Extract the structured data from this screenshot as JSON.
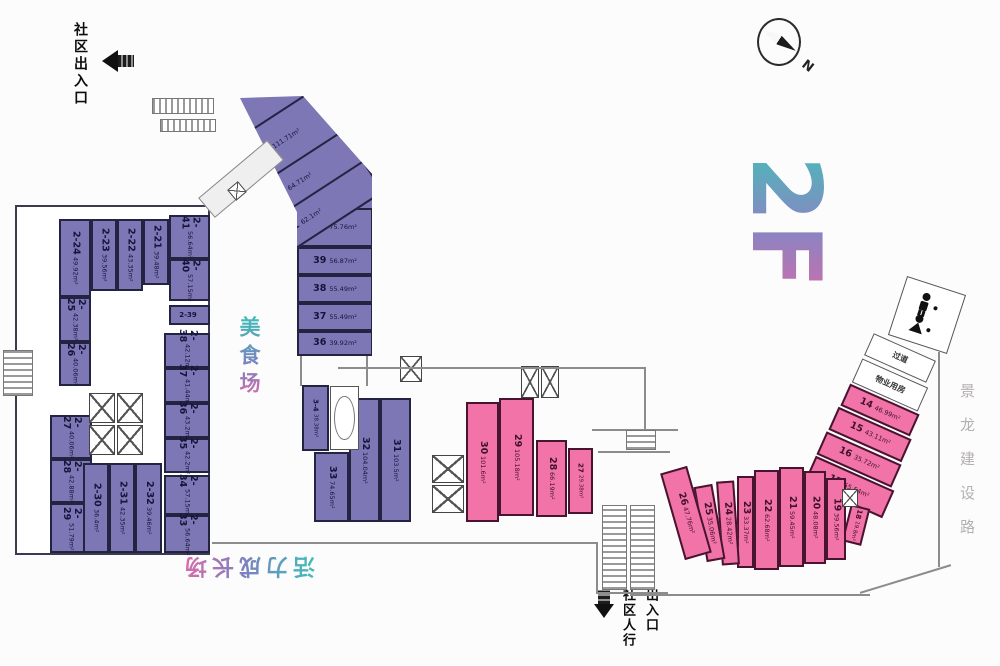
{
  "title": {
    "floor_label": "2F"
  },
  "annotations": {
    "entrance_top": "社区出入口",
    "entrance_bottom_line1": "社区人行",
    "entrance_bottom_line2": "出入口",
    "food_court": "美食场",
    "vitality": "活力成长场",
    "road": "景龙建设路",
    "compass_n": "N",
    "corridor": "过道",
    "property_room": "物业用房"
  },
  "colors": {
    "purple": "#7d77b6",
    "pink": "#f173a8",
    "accent_teal": "#3fbdb8",
    "accent_pink": "#e06aa8"
  },
  "rooms": [
    {
      "n": "40",
      "a": "75.76m²",
      "x": 97,
      "y": 118,
      "w": 76,
      "h": 39,
      "c": "purple",
      "ld": "h",
      "z": "top"
    },
    {
      "n": "39",
      "a": "56.87m²",
      "x": 97,
      "y": 157,
      "w": 76,
      "h": 28,
      "c": "purple",
      "ld": "h",
      "z": "top"
    },
    {
      "n": "38",
      "a": "55.49m²",
      "x": 97,
      "y": 185,
      "w": 76,
      "h": 28,
      "c": "purple",
      "ld": "h",
      "z": "top"
    },
    {
      "n": "37",
      "a": "55.49m²",
      "x": 97,
      "y": 213,
      "w": 76,
      "h": 28,
      "c": "purple",
      "ld": "h",
      "z": "top"
    },
    {
      "n": "36",
      "a": "39.92m²",
      "x": 97,
      "y": 241,
      "w": 76,
      "h": 25,
      "c": "purple",
      "ld": "h",
      "z": "top"
    },
    {
      "n": "43",
      "a": "111.71m²",
      "x": -8,
      "y": 26,
      "w": 175,
      "h": 54,
      "r": -33,
      "c": "purple",
      "ld": "h",
      "z": "top"
    },
    {
      "n": "42",
      "a": "64.71m²",
      "x": 8,
      "y": 76,
      "w": 170,
      "h": 40,
      "r": -33,
      "c": "purple",
      "ld": "h",
      "z": "top"
    },
    {
      "n": "41",
      "a": "62.1m²",
      "x": 22,
      "y": 112,
      "w": 165,
      "h": 38,
      "r": -33,
      "c": "purple",
      "ld": "h",
      "z": "top"
    },
    {
      "n": "2-24",
      "a": "49.92m²",
      "x": 42,
      "y": 12,
      "w": 32,
      "h": 78,
      "c": "purple",
      "ld": "v",
      "z": "left"
    },
    {
      "n": "2-23",
      "a": "39.56m²",
      "x": 74,
      "y": 12,
      "w": 26,
      "h": 72,
      "c": "purple",
      "ld": "v",
      "z": "left"
    },
    {
      "n": "2-22",
      "a": "43.35m²",
      "x": 100,
      "y": 12,
      "w": 26,
      "h": 72,
      "c": "purple",
      "ld": "v",
      "z": "left"
    },
    {
      "n": "2-21",
      "a": "39.48m²",
      "x": 126,
      "y": 12,
      "w": 26,
      "h": 66,
      "c": "purple",
      "ld": "v",
      "z": "left"
    },
    {
      "n": "2-41",
      "a": "56.64m²",
      "x": 152,
      "y": 8,
      "w": 41,
      "h": 44,
      "c": "purple",
      "ld": "v",
      "z": "left"
    },
    {
      "n": "2-40",
      "a": "57.15m²",
      "x": 152,
      "y": 52,
      "w": 41,
      "h": 42,
      "c": "purple",
      "ld": "v",
      "z": "left"
    },
    {
      "n": "2-39",
      "a": "",
      "x": 152,
      "y": 98,
      "w": 41,
      "h": 20,
      "c": "purple",
      "ld": "h",
      "cls": "small",
      "z": "left"
    },
    {
      "n": "2-38",
      "a": "42.12m²",
      "x": 147,
      "y": 126,
      "w": 46,
      "h": 35,
      "c": "purple",
      "ld": "v",
      "z": "left"
    },
    {
      "n": "2-37",
      "a": "41.44m²",
      "x": 147,
      "y": 161,
      "w": 46,
      "h": 35,
      "c": "purple",
      "ld": "v",
      "z": "left"
    },
    {
      "n": "2-36",
      "a": "43.2m²",
      "x": 147,
      "y": 196,
      "w": 46,
      "h": 35,
      "c": "purple",
      "ld": "v",
      "z": "left"
    },
    {
      "n": "2-35",
      "a": "42.2m²",
      "x": 147,
      "y": 231,
      "w": 46,
      "h": 35,
      "c": "purple",
      "ld": "v",
      "z": "left"
    },
    {
      "n": "2-34",
      "a": "57.15m²",
      "x": 147,
      "y": 268,
      "w": 46,
      "h": 40,
      "c": "purple",
      "ld": "v",
      "z": "left"
    },
    {
      "n": "2-33",
      "a": "56.64m²",
      "x": 147,
      "y": 308,
      "w": 46,
      "h": 38,
      "c": "purple",
      "ld": "v",
      "z": "left"
    },
    {
      "n": "2-25",
      "a": "42.38m²",
      "x": 42,
      "y": 90,
      "w": 32,
      "h": 45,
      "c": "purple",
      "ld": "v",
      "z": "left"
    },
    {
      "n": "2-26",
      "a": "40.06m²",
      "x": 42,
      "y": 135,
      "w": 32,
      "h": 44,
      "c": "purple",
      "ld": "v",
      "z": "left"
    },
    {
      "n": "2-27",
      "a": "40.06m²",
      "x": 33,
      "y": 208,
      "w": 42,
      "h": 44,
      "c": "purple",
      "ld": "v",
      "z": "left"
    },
    {
      "n": "2-28",
      "a": "42.88m²",
      "x": 33,
      "y": 252,
      "w": 42,
      "h": 44,
      "c": "purple",
      "ld": "v",
      "z": "left"
    },
    {
      "n": "2-29",
      "a": "51.79m²",
      "x": 33,
      "y": 296,
      "w": 42,
      "h": 50,
      "c": "purple",
      "ld": "v",
      "z": "left"
    },
    {
      "n": "2-30",
      "a": "36.4m²",
      "x": 66,
      "y": 256,
      "w": 26,
      "h": 90,
      "c": "purple",
      "ld": "v",
      "z": "left"
    },
    {
      "n": "2-31",
      "a": "42.35m²",
      "x": 92,
      "y": 256,
      "w": 26,
      "h": 90,
      "c": "purple",
      "ld": "v",
      "z": "left"
    },
    {
      "n": "2-32",
      "a": "39.46m²",
      "x": 118,
      "y": 256,
      "w": 27,
      "h": 90,
      "c": "purple",
      "ld": "v",
      "z": "left"
    },
    {
      "n": "3-4",
      "a": "38.38m²",
      "x": 302,
      "y": 385,
      "w": 27,
      "h": 66,
      "c": "purple",
      "ld": "v",
      "cls": "small"
    },
    {
      "n": "33",
      "a": "74.65m²",
      "x": 314,
      "y": 452,
      "w": 35,
      "h": 70,
      "c": "purple",
      "ld": "v"
    },
    {
      "n": "32",
      "a": "104.04m²",
      "x": 349,
      "y": 398,
      "w": 31,
      "h": 124,
      "c": "purple",
      "ld": "v"
    },
    {
      "n": "31",
      "a": "103.5m²",
      "x": 380,
      "y": 398,
      "w": 31,
      "h": 124,
      "c": "purple",
      "ld": "v"
    },
    {
      "n": "30",
      "a": "101.6m²",
      "x": 466,
      "y": 402,
      "w": 33,
      "h": 120,
      "c": "pink",
      "ld": "v"
    },
    {
      "n": "29",
      "a": "105.18m²",
      "x": 499,
      "y": 398,
      "w": 35,
      "h": 118,
      "c": "pink",
      "ld": "v"
    },
    {
      "n": "28",
      "a": "66.19m²",
      "x": 536,
      "y": 440,
      "w": 31,
      "h": 77,
      "c": "pink",
      "ld": "v"
    },
    {
      "n": "27",
      "a": "29.38m²",
      "x": 568,
      "y": 448,
      "w": 25,
      "h": 66,
      "c": "pink",
      "ld": "v",
      "cls": "small"
    },
    {
      "n": "14",
      "a": "46.99m²",
      "x": 842,
      "y": 398,
      "w": 76,
      "h": 24,
      "r": 24,
      "c": "pink",
      "ld": "h"
    },
    {
      "n": "15",
      "a": "43.11m²",
      "x": 830,
      "y": 422,
      "w": 80,
      "h": 25,
      "r": 24,
      "c": "pink",
      "ld": "h"
    },
    {
      "n": "16",
      "a": "35.72m²",
      "x": 818,
      "y": 447,
      "w": 82,
      "h": 25,
      "r": 24,
      "c": "pink",
      "ld": "h"
    },
    {
      "n": "17",
      "a": "55.54m²",
      "x": 806,
      "y": 472,
      "w": 86,
      "h": 30,
      "r": 24,
      "c": "pink",
      "ld": "h"
    },
    {
      "n": "18",
      "a": "19.8m²",
      "x": 846,
      "y": 506,
      "w": 20,
      "h": 38,
      "r": 14,
      "c": "pink",
      "ld": "v",
      "cls": "small"
    },
    {
      "n": "19",
      "a": "39.56m²",
      "x": 826,
      "y": 478,
      "w": 20,
      "h": 82,
      "c": "pink",
      "ld": "v"
    },
    {
      "n": "20",
      "a": "48.08m²",
      "x": 804,
      "y": 471,
      "w": 22,
      "h": 93,
      "c": "pink",
      "ld": "v"
    },
    {
      "n": "21",
      "a": "59.45m²",
      "x": 779,
      "y": 467,
      "w": 25,
      "h": 100,
      "c": "pink",
      "ld": "v"
    },
    {
      "n": "22",
      "a": "62.68m²",
      "x": 754,
      "y": 470,
      "w": 25,
      "h": 100,
      "c": "pink",
      "ld": "v"
    },
    {
      "n": "23",
      "a": "33.37m²",
      "x": 737,
      "y": 476,
      "w": 17,
      "h": 92,
      "c": "pink",
      "ld": "v"
    },
    {
      "n": "24",
      "a": "28.42m²",
      "x": 719,
      "y": 481,
      "w": 18,
      "h": 84,
      "r": -4,
      "c": "pink",
      "ld": "v"
    },
    {
      "n": "25",
      "a": "35.06m²",
      "x": 700,
      "y": 485,
      "w": 19,
      "h": 76,
      "r": -10,
      "c": "pink",
      "ld": "v"
    },
    {
      "n": "26",
      "a": "47.76m²",
      "x": 672,
      "y": 468,
      "w": 28,
      "h": 90,
      "r": -16,
      "c": "pink",
      "ld": "v"
    },
    {
      "t": "过道",
      "x": 866,
      "y": 346,
      "w": 68,
      "h": 24,
      "r": 24,
      "c": "white",
      "name": "corridor-room"
    },
    {
      "t": "物业用房",
      "x": 854,
      "y": 372,
      "w": 72,
      "h": 26,
      "r": 24,
      "c": "white",
      "name": "property-room"
    }
  ],
  "shapes": [
    {
      "name": "lift-lobby-room",
      "x": 330,
      "y": 386,
      "w": 29,
      "h": 64,
      "c": "white",
      "cls": "ovalbox"
    },
    {
      "name": "shaft-box",
      "x": 400,
      "y": 356,
      "w": 22,
      "h": 26,
      "cls": "xbox"
    },
    {
      "name": "elevator-box",
      "x": 432,
      "y": 455,
      "w": 32,
      "h": 28,
      "cls": "xbox"
    },
    {
      "name": "elevator-box",
      "x": 432,
      "y": 485,
      "w": 32,
      "h": 28,
      "cls": "xbox"
    },
    {
      "name": "elevator-box",
      "x": 521,
      "y": 366,
      "w": 18,
      "h": 32,
      "cls": "xbox"
    },
    {
      "name": "elevator-box",
      "x": 541,
      "y": 366,
      "w": 18,
      "h": 32,
      "cls": "xbox"
    },
    {
      "name": "elevator-box",
      "x": 842,
      "y": 489,
      "w": 16,
      "h": 18,
      "cls": "xbox"
    },
    {
      "name": "elevator-box",
      "z": "left",
      "x": 72,
      "y": 186,
      "w": 26,
      "h": 30,
      "cls": "xbox"
    },
    {
      "name": "elevator-box",
      "z": "left",
      "x": 100,
      "y": 186,
      "w": 26,
      "h": 30,
      "cls": "xbox"
    },
    {
      "name": "elevator-box",
      "z": "left",
      "x": 72,
      "y": 218,
      "w": 26,
      "h": 30,
      "cls": "xbox"
    },
    {
      "name": "elevator-box",
      "z": "left",
      "x": 100,
      "y": 218,
      "w": 26,
      "h": 30,
      "cls": "xbox"
    },
    {
      "name": "corridor-line",
      "x": 338,
      "y": 367,
      "w": 308,
      "h": 2,
      "cls": "ln"
    },
    {
      "name": "corridor-line",
      "x": 644,
      "y": 367,
      "w": 2,
      "h": 64,
      "cls": "ln"
    },
    {
      "name": "corridor-line",
      "x": 592,
      "y": 429,
      "w": 86,
      "h": 2,
      "cls": "ln"
    },
    {
      "name": "corridor-line",
      "x": 598,
      "y": 451,
      "w": 72,
      "h": 2,
      "cls": "ln"
    },
    {
      "name": "corridor-line",
      "x": 212,
      "y": 542,
      "w": 386,
      "h": 2,
      "cls": "ln"
    },
    {
      "name": "corridor-line",
      "x": 596,
      "y": 542,
      "w": 2,
      "h": 52,
      "cls": "ln"
    },
    {
      "name": "corridor-line",
      "x": 598,
      "y": 592,
      "w": 70,
      "h": 2,
      "cls": "ln"
    },
    {
      "name": "corridor-line",
      "x": 300,
      "y": 356,
      "w": 2,
      "h": 30,
      "cls": "ln"
    },
    {
      "name": "corridor-line",
      "x": 366,
      "y": 356,
      "w": 2,
      "h": 30,
      "cls": "ln"
    },
    {
      "name": "building-outline",
      "x": 938,
      "y": 352,
      "w": 2,
      "h": 215,
      "cls": "ln"
    },
    {
      "name": "building-outline",
      "x": 858,
      "y": 578,
      "w": 95,
      "h": 2,
      "r": -17,
      "cls": "ln"
    },
    {
      "name": "building-outline",
      "x": 630,
      "y": 594,
      "w": 240,
      "h": 2,
      "cls": "ln"
    },
    {
      "name": "walkway-bridge",
      "x": 196,
      "y": 166,
      "w": 90,
      "h": 26,
      "r": -40,
      "cls": "bridge"
    },
    {
      "name": "elevator-box",
      "x": 230,
      "y": 184,
      "w": 14,
      "h": 14,
      "r": -40,
      "cls": "xbox"
    },
    {
      "name": "escalator",
      "x": 152,
      "y": 98,
      "w": 62,
      "h": 16,
      "cls": "hatch"
    },
    {
      "name": "escalator",
      "x": 160,
      "y": 119,
      "w": 56,
      "h": 13,
      "cls": "hatch"
    },
    {
      "name": "stairs",
      "x": 3,
      "y": 350,
      "w": 30,
      "h": 46,
      "cls": "hatchH"
    },
    {
      "name": "escalator",
      "x": 602,
      "y": 505,
      "w": 25,
      "h": 85,
      "cls": "hatchH"
    },
    {
      "name": "escalator",
      "x": 630,
      "y": 505,
      "w": 25,
      "h": 85,
      "cls": "hatchH"
    },
    {
      "name": "escalator",
      "x": 626,
      "y": 430,
      "w": 30,
      "h": 20,
      "cls": "hatchH"
    }
  ],
  "restroom": {
    "x": 896,
    "y": 284,
    "w": 62,
    "h": 62,
    "r": 18
  }
}
